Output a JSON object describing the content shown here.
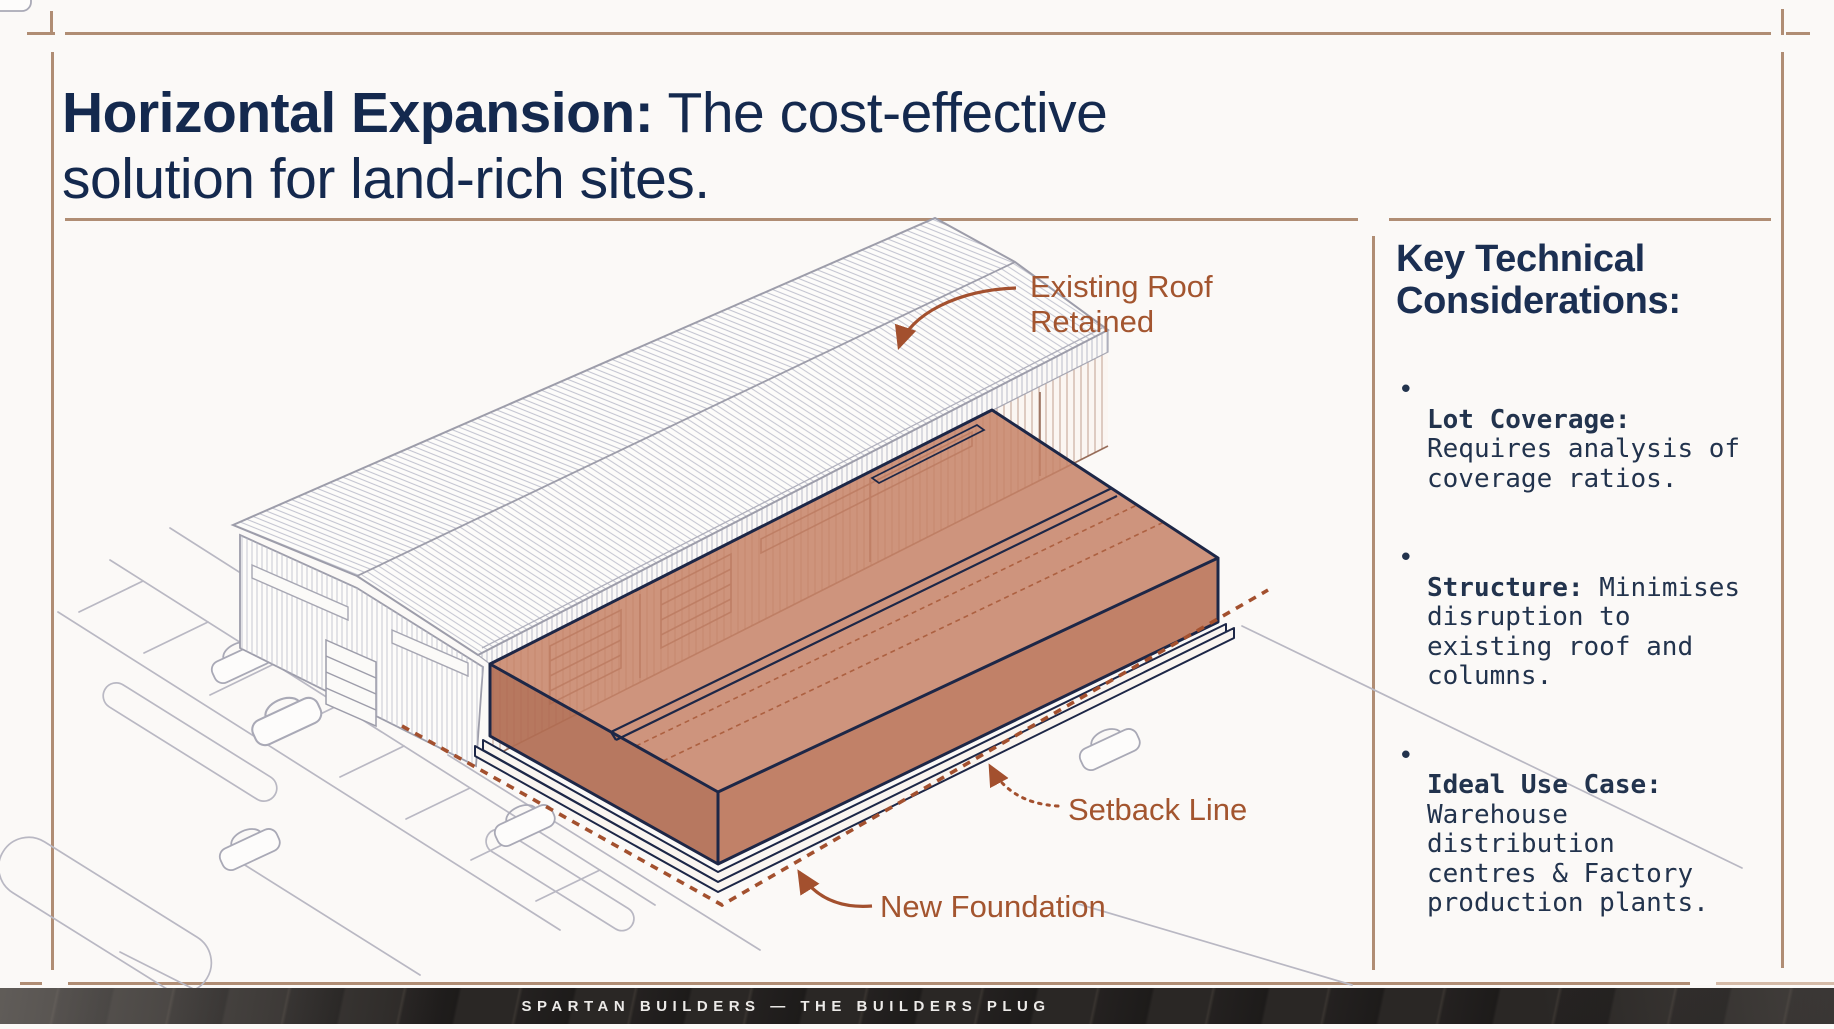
{
  "slide": {
    "title": {
      "bold": "Horizontal Expansion:",
      "rest": " The cost-effective\nsolution for land-rich sites."
    }
  },
  "diagram": {
    "labels": {
      "existing_roof_1": "Existing Roof",
      "existing_roof_2": "Retained",
      "setback": "Setback Line",
      "foundation": "New Foundation"
    }
  },
  "panel": {
    "heading": "Key Technical\nConsiderations:",
    "bullet_char": "•",
    "bullets": [
      {
        "lead": "Lot Coverage:",
        "rest": "\nRequires analysis of\ncoverage ratios."
      },
      {
        "lead": "Structure:",
        "rest": " Minimises\ndisruption to\nexisting roof and\ncolumns."
      },
      {
        "lead": "Ideal Use Case:",
        "rest": "\nWarehouse\ndistribution\ncentres & Factory\nproduction plants."
      }
    ]
  },
  "footer": {
    "text": "SPARTAN BUILDERS — THE BUILDERS PLUG"
  },
  "colors": {
    "navy_title": "#14294e",
    "navy_outline": "#1d2747",
    "terracotta_label": "#a3552f",
    "terracotta_dash": "#a3502e",
    "orange_fill": "#c5856b",
    "rule_tan": "#b08d74",
    "line_gray": "#9d9daa"
  }
}
